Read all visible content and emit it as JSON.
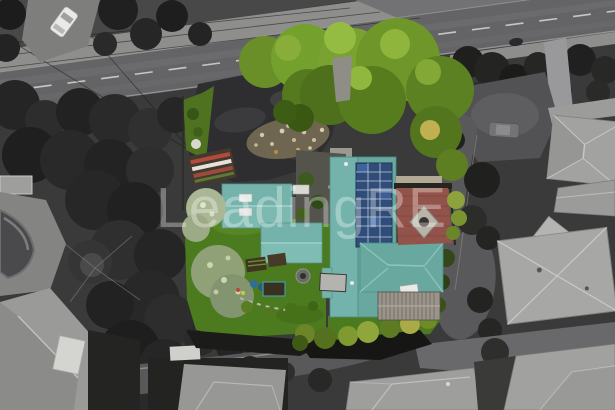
{
  "scene": {
    "description": "Aerial drone photograph of a residential property: teal-roofed house with rooftop solar panels, garage and studio outbuildings, lawns, gardens and a brick courtyard shown in colour, surrounded by desaturated grayscale neighbouring houses, dark trees, a main road along the top with power lines and a white car, and a cul-de-sac street curving around the property."
  },
  "watermark": {
    "text": "LeadingRE",
    "color": "rgba(255,255,255,0.33)"
  },
  "colors": {
    "road_gray": "#646466",
    "footpath_gray": "#8e8e8c",
    "driveway_asphalt": "#2e2e30",
    "roof_teal": "#74b3ab",
    "roof_teal_shaded": "#68a89f",
    "solar_panel_blue": "#2f4d78",
    "lawn_green": "#4c7a1e",
    "canopy_green": "#6e9629",
    "sage_tree_green": "#90a077",
    "brick_courtyard_red": "#92544a",
    "pergola_gray": "#9a948a",
    "neighbor_roof_gray": "#a7a7a5",
    "white_car": "#e9e9e7"
  }
}
